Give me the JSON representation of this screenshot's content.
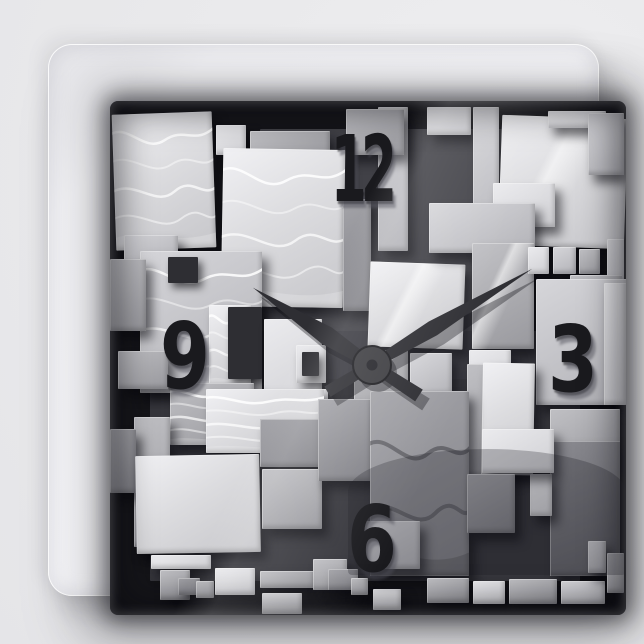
{
  "scene": {
    "description": "Product photo of a square wall clock; the face is an abstract 3D collage of overlapping grayscale rectangular blocks with wavy and glassy textures",
    "background_color": "#e9e9eb",
    "frame_color": "#f4f4f7"
  },
  "clock": {
    "time_displayed": "10:10",
    "hour_angle_deg": 303,
    "minute_angle_deg": 59,
    "hand_color": "#2e2e33",
    "hand_shadow_color": "rgba(10,10,14,0.35)",
    "hub_color": "#3d3d41",
    "hub_ring_color": "#1e1e22",
    "hub": {
      "x": 262,
      "y": 264,
      "r": 19
    },
    "hour_hand": {
      "length": 142,
      "tail": 56,
      "base_w": 5,
      "max_w": 9.5,
      "tail_w": 7
    },
    "minute_hand": {
      "length": 187,
      "tail": 52,
      "base_w": 4.5,
      "max_w": 8,
      "tail_w": 6
    },
    "numerals": [
      {
        "value": "12",
        "position": "top"
      },
      {
        "value": "3",
        "position": "right"
      },
      {
        "value": "6",
        "position": "bottom"
      },
      {
        "value": "9",
        "position": "left"
      }
    ],
    "numeral_color": "#1a1a1e"
  },
  "artwork": {
    "gap_color": "#151519",
    "palette": {
      "light": "#dcdcdf",
      "lighter": "#d6d6da",
      "midlight": "#c0c0c6",
      "mid": "#a8a8ad",
      "middark": "#8f8f94",
      "dark": "#6b6b70",
      "darkflat": "#2e2e33"
    },
    "blocks": [
      {
        "x": 150,
        "y": 28,
        "w": 260,
        "h": 250,
        "s": "backdim"
      },
      {
        "x": 40,
        "y": 230,
        "w": 430,
        "h": 250,
        "s": "backdim2"
      },
      {
        "x": 4,
        "y": 12,
        "w": 100,
        "h": 136,
        "s": "light",
        "t": "waves",
        "r": -2
      },
      {
        "x": 106,
        "y": 24,
        "w": 30,
        "h": 30,
        "s": "lighter"
      },
      {
        "x": 140,
        "y": 30,
        "w": 80,
        "h": 26,
        "s": "mid"
      },
      {
        "x": 112,
        "y": 48,
        "w": 122,
        "h": 158,
        "s": "light",
        "t": "waves",
        "r": 1
      },
      {
        "x": 14,
        "y": 134,
        "w": 54,
        "h": 30,
        "s": "midlight"
      },
      {
        "x": 30,
        "y": 150,
        "w": 122,
        "h": 142,
        "s": "midlight",
        "t": "waves"
      },
      {
        "x": 0,
        "y": 158,
        "w": 36,
        "h": 72,
        "s": "mid"
      },
      {
        "x": 58,
        "y": 156,
        "w": 30,
        "h": 26,
        "s": "darkflat"
      },
      {
        "x": 99,
        "y": 204,
        "w": 42,
        "h": 82,
        "s": "light",
        "t": "waves"
      },
      {
        "x": 118,
        "y": 206,
        "w": 34,
        "h": 72,
        "s": "darkflat"
      },
      {
        "x": 154,
        "y": 218,
        "w": 58,
        "h": 100,
        "s": "lighter"
      },
      {
        "x": 186,
        "y": 244,
        "w": 30,
        "h": 38,
        "s": "lighter"
      },
      {
        "x": 192,
        "y": 251,
        "w": 17,
        "h": 24,
        "s": "darkflat"
      },
      {
        "x": 186,
        "y": 288,
        "w": 32,
        "h": 30,
        "s": "lighter"
      },
      {
        "x": 193,
        "y": 294,
        "w": 18,
        "h": 18,
        "s": "darkflat"
      },
      {
        "x": 60,
        "y": 282,
        "w": 84,
        "h": 62,
        "s": "mid",
        "t": "waves"
      },
      {
        "x": 96,
        "y": 288,
        "w": 118,
        "h": 64,
        "s": "light",
        "t": "waves"
      },
      {
        "x": 8,
        "y": 250,
        "w": 50,
        "h": 38,
        "s": "mid"
      },
      {
        "x": 24,
        "y": 316,
        "w": 36,
        "h": 130,
        "s": "mid"
      },
      {
        "x": 0,
        "y": 328,
        "w": 26,
        "h": 64,
        "s": "middark"
      },
      {
        "x": 26,
        "y": 354,
        "w": 124,
        "h": 98,
        "s": "light",
        "r": -1
      },
      {
        "x": 150,
        "y": 318,
        "w": 78,
        "h": 48,
        "s": "middark"
      },
      {
        "x": 152,
        "y": 368,
        "w": 60,
        "h": 60,
        "s": "mid"
      },
      {
        "x": 41,
        "y": 454,
        "w": 60,
        "h": 14,
        "s": "lighter"
      },
      {
        "x": 50,
        "y": 469,
        "w": 30,
        "h": 30,
        "s": "mid"
      },
      {
        "x": 68,
        "y": 477,
        "w": 22,
        "h": 17,
        "s": "middark"
      },
      {
        "x": 86,
        "y": 480,
        "w": 18,
        "h": 17,
        "s": "mid"
      },
      {
        "x": 105,
        "y": 467,
        "w": 40,
        "h": 27,
        "s": "lighter"
      },
      {
        "x": 150,
        "y": 470,
        "w": 55,
        "h": 17,
        "s": "mid"
      },
      {
        "x": 152,
        "y": 492,
        "w": 40,
        "h": 21,
        "s": "lighter"
      },
      {
        "x": 203,
        "y": 458,
        "w": 34,
        "h": 31,
        "s": "mid"
      },
      {
        "x": 218,
        "y": 468,
        "w": 30,
        "h": 21,
        "s": "middark"
      },
      {
        "x": 241,
        "y": 477,
        "w": 17,
        "h": 17,
        "s": "mid"
      },
      {
        "x": 263,
        "y": 488,
        "w": 28,
        "h": 21,
        "s": "lighter"
      },
      {
        "x": 233,
        "y": 98,
        "w": 28,
        "h": 112,
        "s": "middark"
      },
      {
        "x": 268,
        "y": 6,
        "w": 30,
        "h": 144,
        "s": "midlight"
      },
      {
        "x": 236,
        "y": 8,
        "w": 58,
        "h": 46,
        "s": "mid"
      },
      {
        "x": 259,
        "y": 162,
        "w": 95,
        "h": 85,
        "s": "light",
        "t": "glass",
        "r": 2
      },
      {
        "x": 244,
        "y": 249,
        "w": 54,
        "h": 75,
        "s": "mid"
      },
      {
        "x": 208,
        "y": 298,
        "w": 54,
        "h": 82,
        "s": "middark"
      },
      {
        "x": 300,
        "y": 252,
        "w": 42,
        "h": 42,
        "s": "midlight"
      },
      {
        "x": 317,
        "y": 6,
        "w": 44,
        "h": 28,
        "s": "lighter"
      },
      {
        "x": 363,
        "y": 6,
        "w": 26,
        "h": 142,
        "s": "midlight"
      },
      {
        "x": 390,
        "y": 16,
        "w": 126,
        "h": 130,
        "s": "light",
        "t": "glass",
        "r": 2
      },
      {
        "x": 383,
        "y": 82,
        "w": 62,
        "h": 44,
        "s": "lighter"
      },
      {
        "x": 438,
        "y": 10,
        "w": 58,
        "h": 17,
        "s": "lighter"
      },
      {
        "x": 478,
        "y": 12,
        "w": 36,
        "h": 62,
        "s": "midlight"
      },
      {
        "x": 319,
        "y": 102,
        "w": 106,
        "h": 50,
        "s": "midlight"
      },
      {
        "x": 362,
        "y": 142,
        "w": 62,
        "h": 106,
        "s": "mid",
        "t": "glass"
      },
      {
        "x": 418,
        "y": 146,
        "w": 21,
        "h": 27,
        "s": "lighter"
      },
      {
        "x": 443,
        "y": 146,
        "w": 23,
        "h": 27,
        "s": "midlight"
      },
      {
        "x": 469,
        "y": 148,
        "w": 21,
        "h": 25,
        "s": "mid"
      },
      {
        "x": 497,
        "y": 138,
        "w": 17,
        "h": 84,
        "s": "midlight"
      },
      {
        "x": 460,
        "y": 174,
        "w": 52,
        "h": 60,
        "s": "mid"
      },
      {
        "x": 426,
        "y": 178,
        "w": 92,
        "h": 126,
        "s": "midlight"
      },
      {
        "x": 494,
        "y": 182,
        "w": 22,
        "h": 122,
        "s": "lighter"
      },
      {
        "x": 359,
        "y": 249,
        "w": 42,
        "h": 42,
        "s": "lighter"
      },
      {
        "x": 357,
        "y": 263,
        "w": 48,
        "h": 112,
        "s": "mid"
      },
      {
        "x": 372,
        "y": 262,
        "w": 52,
        "h": 112,
        "s": "light",
        "r": 1
      },
      {
        "x": 260,
        "y": 290,
        "w": 99,
        "h": 185,
        "s": "middark",
        "t": "waves2"
      },
      {
        "x": 440,
        "y": 308,
        "w": 70,
        "h": 60,
        "s": "mid"
      },
      {
        "x": 440,
        "y": 340,
        "w": 70,
        "h": 135,
        "s": "dark"
      },
      {
        "x": 420,
        "y": 373,
        "w": 22,
        "h": 42,
        "s": "lighter"
      },
      {
        "x": 372,
        "y": 328,
        "w": 72,
        "h": 44,
        "s": "lighter"
      },
      {
        "x": 357,
        "y": 373,
        "w": 48,
        "h": 59,
        "s": "middark"
      },
      {
        "x": 252,
        "y": 420,
        "w": 58,
        "h": 48,
        "s": "midlight"
      },
      {
        "x": 317,
        "y": 477,
        "w": 42,
        "h": 25,
        "s": "mid"
      },
      {
        "x": 363,
        "y": 480,
        "w": 32,
        "h": 23,
        "s": "lighter"
      },
      {
        "x": 399,
        "y": 478,
        "w": 48,
        "h": 25,
        "s": "mid"
      },
      {
        "x": 451,
        "y": 480,
        "w": 44,
        "h": 23,
        "s": "midlight"
      },
      {
        "x": 478,
        "y": 440,
        "w": 18,
        "h": 32,
        "s": "midlight"
      },
      {
        "x": 497,
        "y": 452,
        "w": 17,
        "h": 40,
        "s": "mid"
      }
    ]
  }
}
